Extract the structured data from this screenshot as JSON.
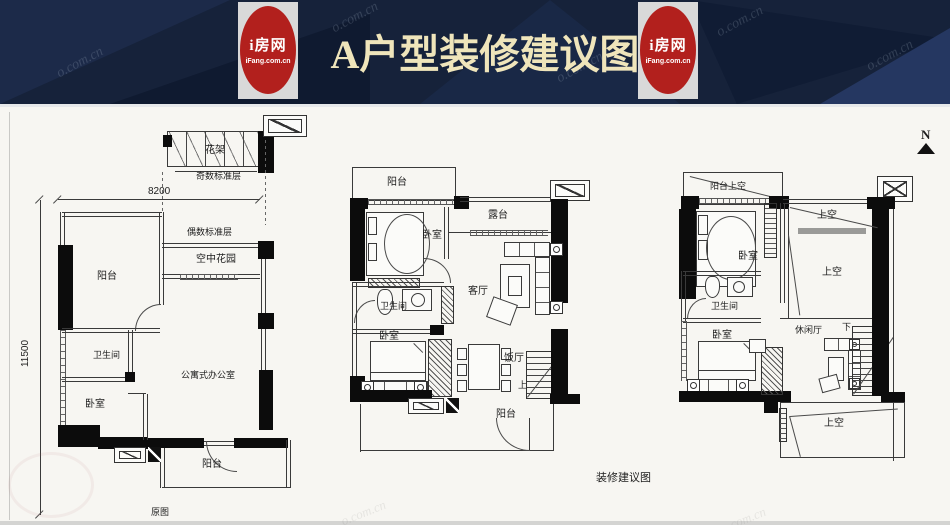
{
  "header": {
    "title": "A户型装修建议图",
    "logo_name": "i房网",
    "logo_domain": "iFang.com.cn",
    "watermark": "o.com.cn",
    "colors": {
      "bg": "#16223a",
      "logo_red": "#b2201d",
      "title": "#efe5bb"
    }
  },
  "compass": {
    "label": "N"
  },
  "captions": {
    "left": "原图",
    "middle": "装修建议图"
  },
  "dimensions": {
    "width": "8200",
    "height": "11500"
  },
  "left_plan": {
    "flower_rack": "花架",
    "odd_floor": "奇数标准层",
    "even_floor": "偶数标准层",
    "sky_garden": "空中花园",
    "balcony_top": "阳台",
    "bathroom": "卫生间",
    "bedroom": "卧室",
    "office": "公寓式办公室",
    "balcony_bottom": "阳台"
  },
  "middle_plan": {
    "balcony_top": "阳台",
    "bedroom_top": "卧室",
    "terrace": "露台",
    "living_room": "客厅",
    "bathroom": "卫生间",
    "bedroom_bottom": "卧室",
    "dining_room": "饭厅",
    "stairs_up": "上",
    "balcony_bottom": "阳台"
  },
  "right_plan": {
    "balcony_void": "阳台上空",
    "bedroom_top": "卧室",
    "void_upper": "上空",
    "void_middle": "上空",
    "bathroom": "卫生间",
    "bedroom_bottom": "卧室",
    "leisure_hall": "休闲厅",
    "stairs_down": "下",
    "void_bottom": "上空"
  }
}
